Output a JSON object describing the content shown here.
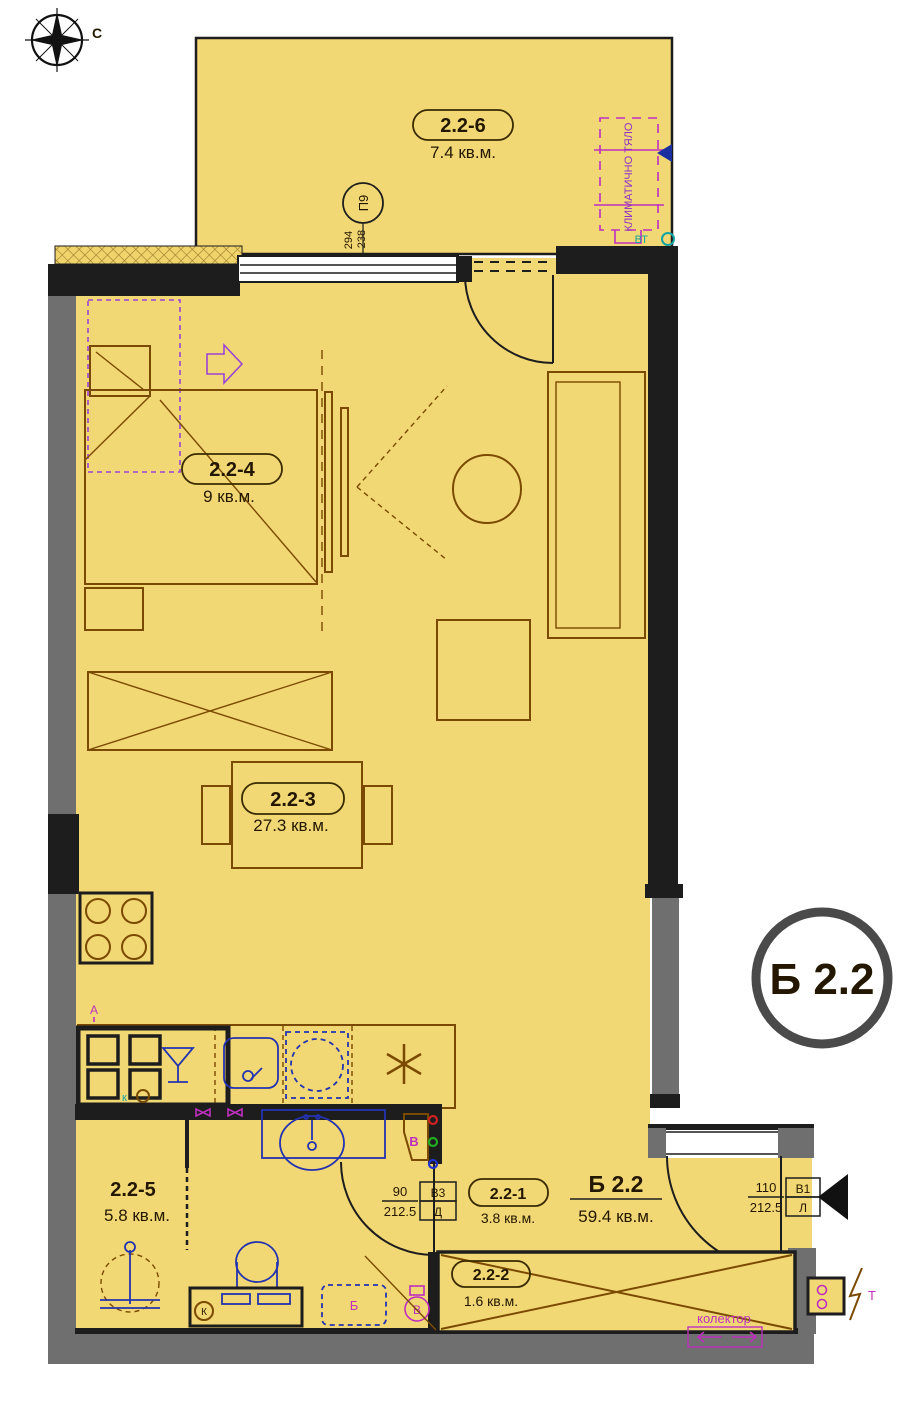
{
  "meta": {
    "compass_north": "С"
  },
  "unit": {
    "name": "Б 2.2",
    "area": "59.4 кв.м."
  },
  "rooms": [
    {
      "id": "2.2-6",
      "area": "7.4 кв.м."
    },
    {
      "id": "2.2-4",
      "area": "9 кв.м."
    },
    {
      "id": "2.2-3",
      "area": "27.3 кв.м."
    },
    {
      "id": "2.2-5",
      "area": "5.8 кв.м."
    },
    {
      "id": "2.2-1",
      "area": "3.8 кв.м."
    },
    {
      "id": "2.2-2",
      "area": "1.6 кв.м."
    }
  ],
  "doors": [
    {
      "width": "90",
      "height": "212.5",
      "code": "В3",
      "letter": "Д"
    },
    {
      "width": "110",
      "height": "212.5",
      "code": "В1",
      "letter": "Л"
    }
  ],
  "window_marker": {
    "code": "П9",
    "width": "294",
    "height": "238"
  },
  "annotations": {
    "ac_unit": "КЛИМАТИЧНО ТЯЛО",
    "vt": "ВТ",
    "collector": "колектор",
    "outlet_a": "А",
    "k_small": "к",
    "k_circled": "К",
    "washer_b": "Б",
    "boiler_v": "В",
    "shaft_v": "В",
    "meter_t": "Т"
  },
  "colors": {
    "floor": "#F2D874",
    "wall_black": "#1d1d1d",
    "wall_gray": "#6f6f6f",
    "furniture_brown": "#7a4a00",
    "plumbing_blue": "#2333b0",
    "annotation_magenta": "#be2fbe",
    "annotation_purple": "#9a44d4",
    "teal": "#14a3a3",
    "badge_ring": "#4a4a4a"
  }
}
